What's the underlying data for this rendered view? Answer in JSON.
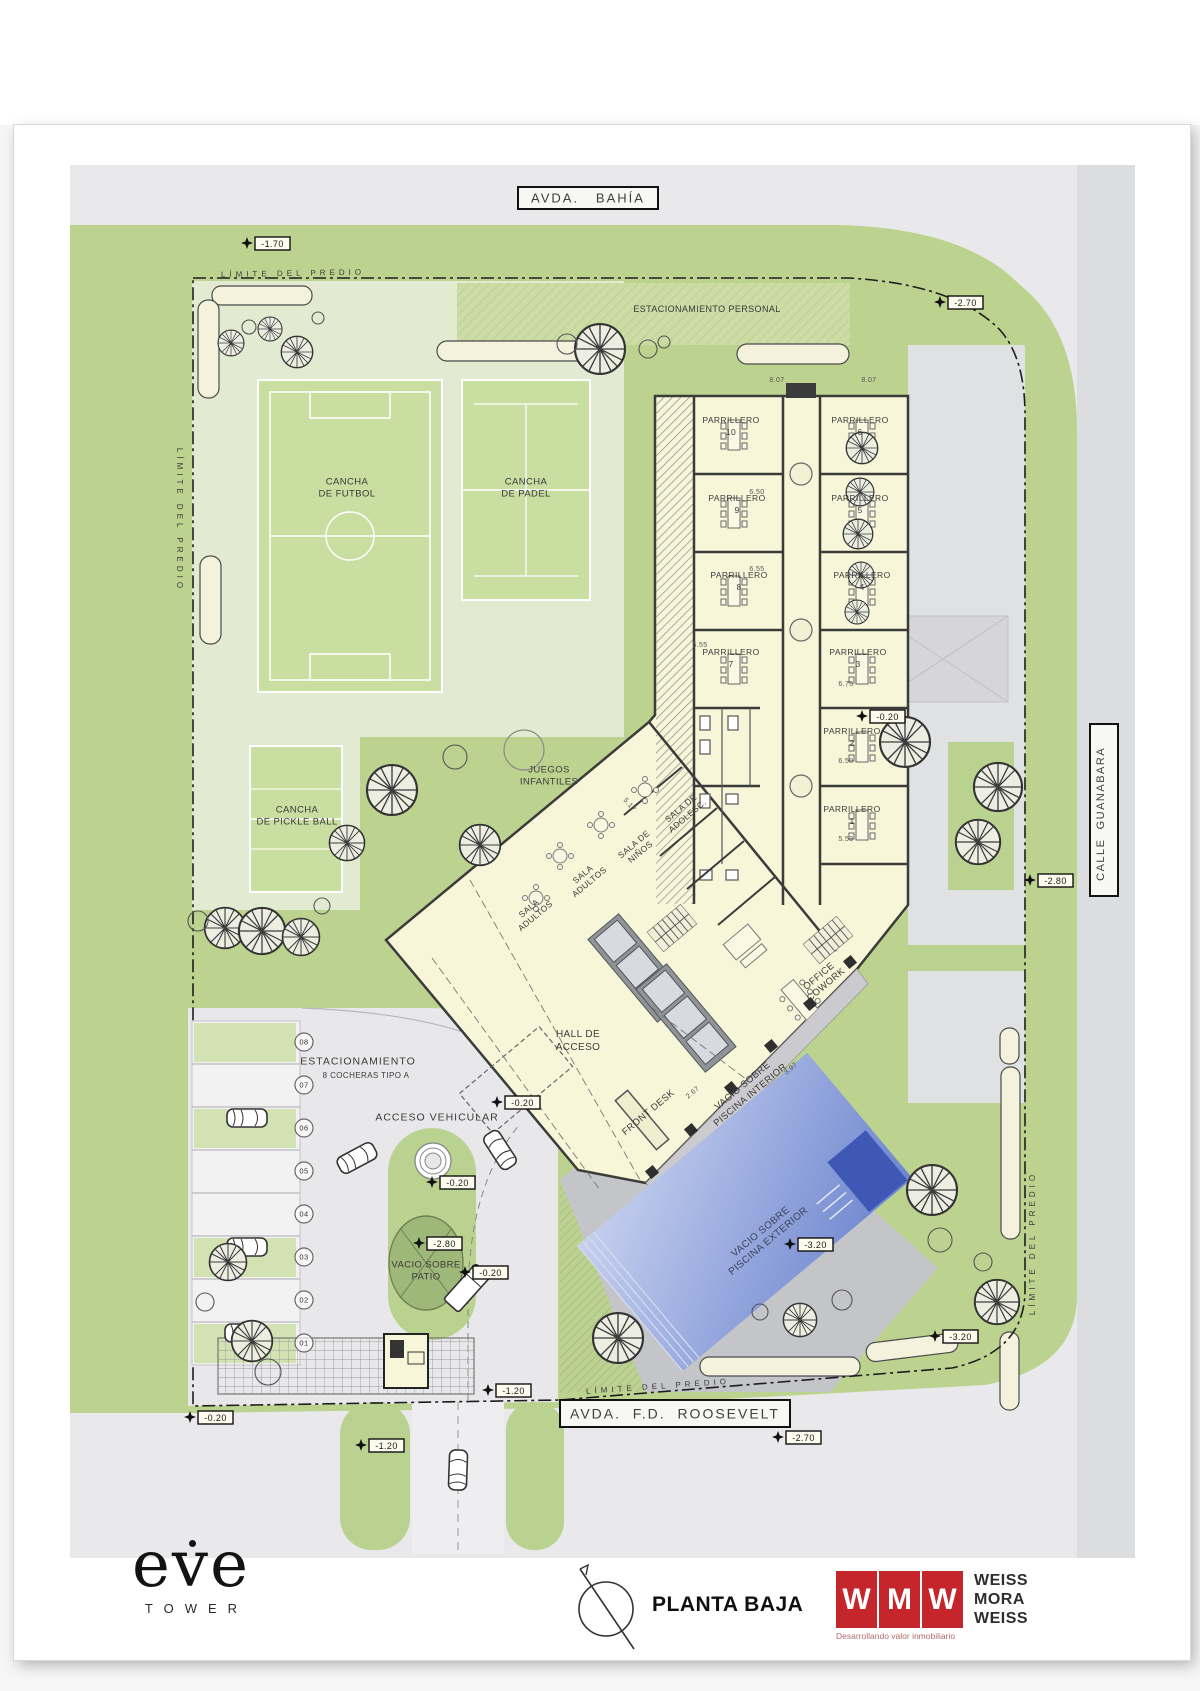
{
  "sheet": {
    "type": "architectural site plan"
  },
  "plan": {
    "street_labels": [
      {
        "text": "AVDA.   BAHÍA",
        "bx": 518,
        "by": 187,
        "bw": 140,
        "bh": 22,
        "size": 13,
        "ls": 2,
        "rot": 0
      },
      {
        "text": "CALLE  GUANABARA",
        "bx": 1090,
        "by": 724,
        "bw": 28,
        "bh": 172,
        "size": 11,
        "ls": 1.5,
        "rot": -90
      },
      {
        "text": "AVDA.  F.D.  ROOSEVELT",
        "bx": 560,
        "by": 1400,
        "bw": 230,
        "bh": 27,
        "size": 14,
        "ls": 2,
        "rot": 0
      }
    ],
    "labels": [
      {
        "lines": [
          "ESTACIONAMIENTO PERSONAL"
        ],
        "x": 707,
        "y": 309,
        "size": 9
      },
      {
        "lines": [
          "LÍMITE DEL PREDIO"
        ],
        "x": 293,
        "y": 273,
        "size": 8,
        "ls": 4,
        "rot": -1
      },
      {
        "lines": [
          "LÍMITE DEL PREDIO"
        ],
        "x": 180,
        "y": 520,
        "size": 8,
        "ls": 4,
        "rot": 90
      },
      {
        "lines": [
          "LÍMITE DEL PREDIO"
        ],
        "x": 1032,
        "y": 1243,
        "size": 8,
        "ls": 4,
        "rot": -90
      },
      {
        "lines": [
          "LÍMITE DEL PREDIO"
        ],
        "x": 658,
        "y": 1386,
        "size": 8,
        "ls": 4,
        "rot": -4
      },
      {
        "lines": [
          "CANCHA",
          "DE FUTBOL"
        ],
        "x": 347,
        "y": 487,
        "size": 9.5,
        "lh": 12
      },
      {
        "lines": [
          "CANCHA",
          "DE PADEL"
        ],
        "x": 526,
        "y": 487,
        "size": 9.5,
        "lh": 12
      },
      {
        "lines": [
          "CANCHA",
          "DE PICKLE BALL"
        ],
        "x": 297,
        "y": 815,
        "size": 9.5,
        "lh": 12
      },
      {
        "lines": [
          "JUEGOS",
          "INFANTILES"
        ],
        "x": 549,
        "y": 775,
        "size": 9.5,
        "lh": 12
      },
      {
        "lines": [
          "ESTACIONAMIENTO"
        ],
        "x": 358,
        "y": 1061,
        "size": 10.5,
        "ls": 1
      },
      {
        "lines": [
          "8 COCHERAS TIPO A"
        ],
        "x": 366,
        "y": 1075,
        "size": 8
      },
      {
        "lines": [
          "ACCESO VEHICULAR"
        ],
        "x": 437,
        "y": 1117,
        "size": 10.5,
        "ls": 1
      },
      {
        "lines": [
          "VACIO SOBRE",
          "PATIO"
        ],
        "x": 426,
        "y": 1270,
        "size": 9.5,
        "lh": 12
      },
      {
        "lines": [
          "HALL DE",
          "ACCESO"
        ],
        "x": 578,
        "y": 1040,
        "size": 10,
        "lh": 13
      },
      {
        "lines": [
          "FRONT DESK"
        ],
        "x": 648,
        "y": 1112,
        "rot": -40,
        "size": 9.5
      },
      {
        "lines": [
          "VACIO SOBRE",
          "PISCINA INTERIOR"
        ],
        "x": 746,
        "y": 1090,
        "rot": -40,
        "size": 9.5,
        "lh": 12
      },
      {
        "lines": [
          "OFFICE",
          "COWORK"
        ],
        "x": 822,
        "y": 980,
        "rot": -40,
        "size": 9.5,
        "lh": 11
      },
      {
        "lines": [
          "VACIO SOBRE",
          "PISCINA EXTERIOR"
        ],
        "x": 764,
        "y": 1236,
        "rot": -40,
        "size": 10,
        "lh": 12,
        "color": "#3e4358"
      },
      {
        "lines": [
          "SALA DE",
          "ADOLESC."
        ],
        "x": 684,
        "y": 812,
        "rot": -40,
        "size": 8.5,
        "lh": 10
      },
      {
        "lines": [
          "SALA DE",
          "NIÑOS"
        ],
        "x": 637,
        "y": 848,
        "rot": -40,
        "size": 8.5,
        "lh": 10
      },
      {
        "lines": [
          "SALA",
          "ADULTOS"
        ],
        "x": 586,
        "y": 878,
        "rot": -40,
        "size": 8.5,
        "lh": 10
      },
      {
        "lines": [
          "SALA",
          "ADULTOS"
        ],
        "x": 532,
        "y": 912,
        "rot": -40,
        "size": 8.5,
        "lh": 10
      }
    ],
    "parrilleros": {
      "word": "PARRILLERO",
      "units": [
        {
          "n": "10",
          "x": 731,
          "y": 423
        },
        {
          "n": "9",
          "x": 737,
          "y": 501
        },
        {
          "n": "8",
          "x": 739,
          "y": 578
        },
        {
          "n": "7",
          "x": 731,
          "y": 655
        },
        {
          "n": "6",
          "x": 860,
          "y": 423
        },
        {
          "n": "5",
          "x": 860,
          "y": 501
        },
        {
          "n": "4",
          "x": 862,
          "y": 578
        },
        {
          "n": "3",
          "x": 858,
          "y": 655
        },
        {
          "n": "2",
          "x": 852,
          "y": 734
        },
        {
          "n": "1",
          "x": 852,
          "y": 812
        }
      ]
    },
    "level_markers": [
      {
        "v": "-1.70",
        "x": 255,
        "y": 237
      },
      {
        "v": "-2.70",
        "x": 948,
        "y": 296
      },
      {
        "v": "-0.20",
        "x": 870,
        "y": 710
      },
      {
        "v": "-2.80",
        "x": 1038,
        "y": 874
      },
      {
        "v": "-0.20",
        "x": 505,
        "y": 1096
      },
      {
        "v": "-0.20",
        "x": 440,
        "y": 1176
      },
      {
        "v": "-2.80",
        "x": 427,
        "y": 1237
      },
      {
        "v": "-0.20",
        "x": 473,
        "y": 1266
      },
      {
        "v": "-3.20",
        "x": 798,
        "y": 1238
      },
      {
        "v": "-3.20",
        "x": 943,
        "y": 1330
      },
      {
        "v": "-1.20",
        "x": 496,
        "y": 1384
      },
      {
        "v": "-0.20",
        "x": 198,
        "y": 1411
      },
      {
        "v": "-2.70",
        "x": 786,
        "y": 1431
      },
      {
        "v": "-1.20",
        "x": 369,
        "y": 1439
      }
    ],
    "dimensions": [
      {
        "v": "8.07",
        "x": 777,
        "y": 382
      },
      {
        "v": "8.07",
        "x": 869,
        "y": 382
      },
      {
        "v": "6.50",
        "x": 757,
        "y": 494
      },
      {
        "v": "6.55",
        "x": 757,
        "y": 571
      },
      {
        "v": "6.55",
        "x": 700,
        "y": 647
      },
      {
        "v": "6.75",
        "x": 846,
        "y": 686
      },
      {
        "v": "6.50",
        "x": 846,
        "y": 763
      },
      {
        "v": "5.53",
        "x": 846,
        "y": 841
      },
      {
        "v": "5.17",
        "x": 628,
        "y": 806,
        "rot": 50
      },
      {
        "v": "3.97",
        "x": 792,
        "y": 1070,
        "rot": -40
      },
      {
        "v": "2.67",
        "x": 694,
        "y": 1094,
        "rot": -40
      }
    ],
    "parking_stalls": [
      "08",
      "07",
      "06",
      "05",
      "04",
      "03",
      "02",
      "01"
    ]
  },
  "footer": {
    "eve": {
      "word": "eve",
      "sub": "TOWER"
    },
    "title": "PLANTA BAJA",
    "wmw": {
      "letters": [
        "W",
        "M",
        "W"
      ],
      "names": [
        "WEISS",
        "MORA",
        "WEISS"
      ],
      "tagline": "Desarrollando valor inmobiliario"
    }
  }
}
